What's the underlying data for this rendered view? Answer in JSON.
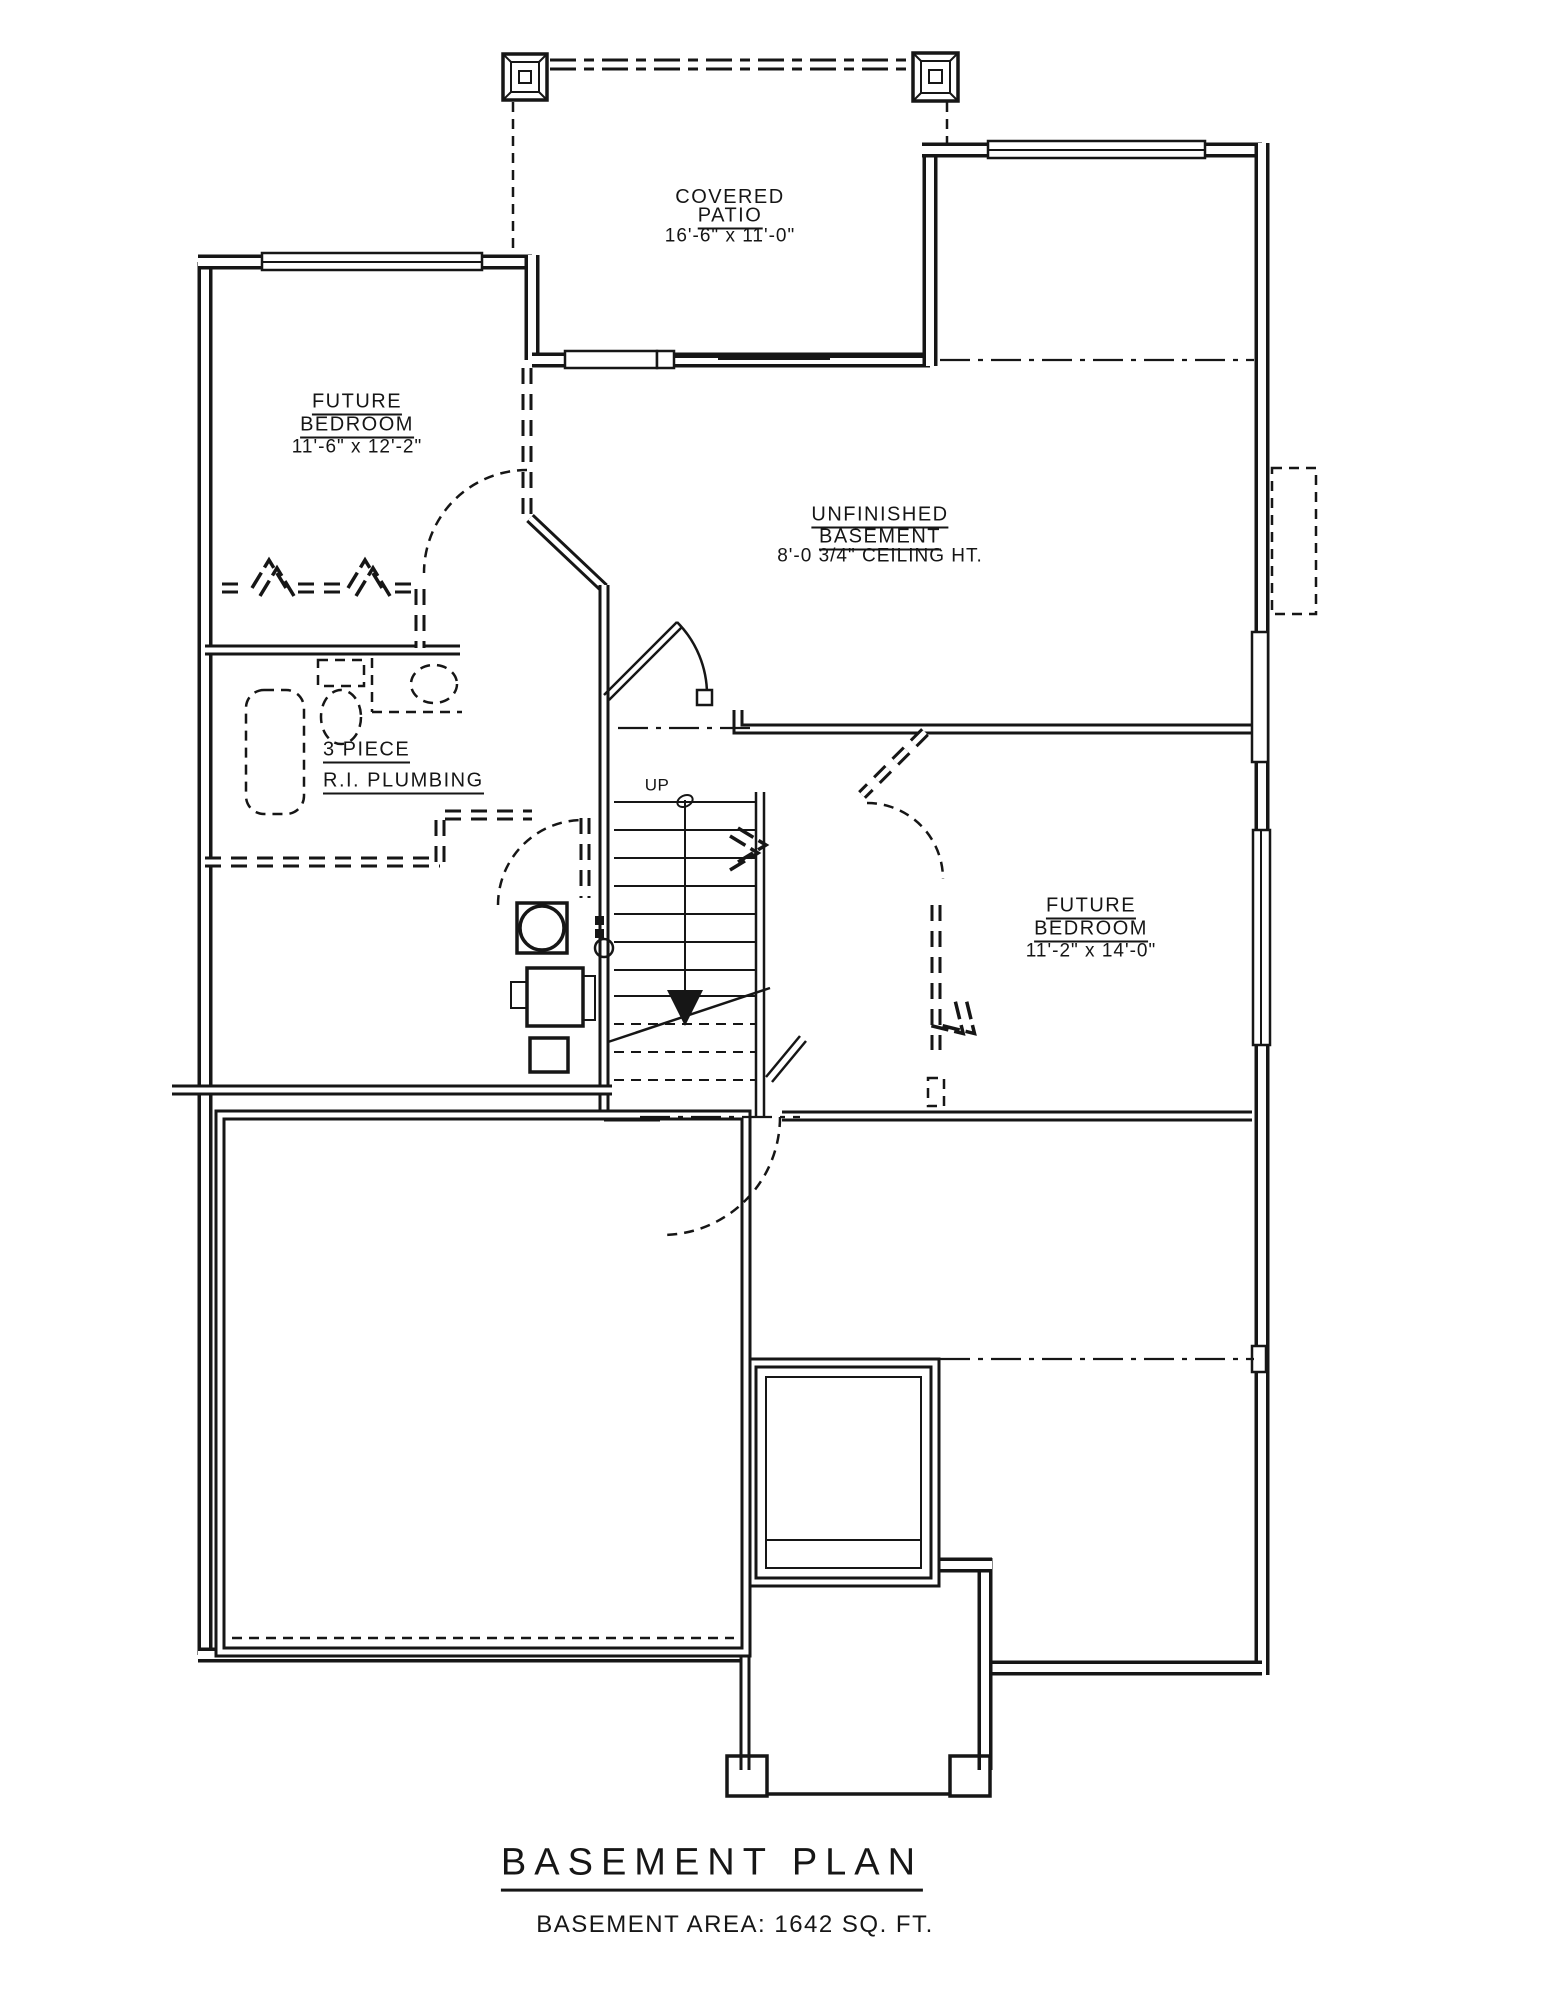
{
  "page": {
    "background": "#ffffff",
    "line_color": "#161616",
    "drawing_type": "architectural floor plan"
  },
  "title_block": {
    "title": "BASEMENT PLAN",
    "subtitle": "BASEMENT AREA: 1642 SQ. FT."
  },
  "rooms": {
    "covered_patio": {
      "line1": "COVERED",
      "line2": "PATIO",
      "dims": "16'-6\" x 11'-0\""
    },
    "future_bedroom_left": {
      "line1": "FUTURE",
      "line2": "BEDROOM",
      "dims": "11'-6\" x 12'-2\""
    },
    "unfinished_basement": {
      "line1": "UNFINISHED",
      "line2": "BASEMENT",
      "note": "8'-0 3/4\" CEILING HT."
    },
    "future_bedroom_right": {
      "line1": "FUTURE",
      "line2": "BEDROOM",
      "dims": "11'-2\" x 14'-0\""
    },
    "bath_rough_in": {
      "line1": "3 PIECE",
      "line2": "R.I. PLUMBING"
    }
  },
  "stairs": {
    "direction_label": "UP"
  },
  "fixtures": [
    "bathtub",
    "toilet",
    "sink",
    "water-heater",
    "furnace",
    "stairs",
    "patio-posts",
    "stoop-posts"
  ]
}
